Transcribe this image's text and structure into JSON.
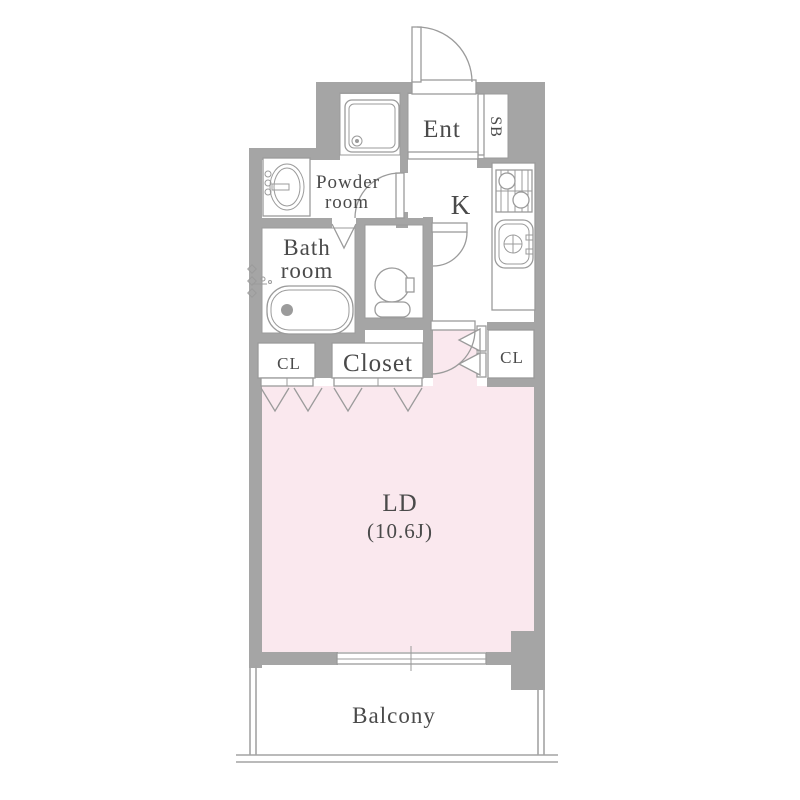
{
  "floorplan": {
    "type": "apartment-floor-plan",
    "rooms": {
      "entrance": {
        "label": "Ent"
      },
      "shoe_box": {
        "label": "SB"
      },
      "powder_room": {
        "label_line1": "Powder",
        "label_line2": "room"
      },
      "kitchen": {
        "label": "K"
      },
      "bath_room": {
        "label_line1": "Bath",
        "label_line2": "room"
      },
      "closet_left": {
        "label": "CL"
      },
      "closet_main": {
        "label": "Closet"
      },
      "closet_right": {
        "label": "CL"
      },
      "living_dining": {
        "label": "LD",
        "size_label": "(10.6J)"
      },
      "balcony": {
        "label": "Balcony"
      }
    },
    "colors": {
      "wall": "#a5a5a5",
      "ld_floor": "#fae8ee",
      "fixture_outline": "#9b9b9b",
      "text": "#4a4a4a",
      "background": "#ffffff"
    }
  }
}
